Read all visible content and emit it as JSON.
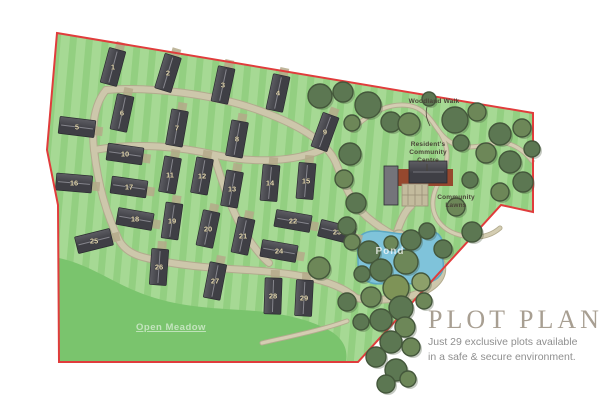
{
  "title_block": {
    "title": "PLOT PLAN",
    "subtitle_line1": "Just 29 exclusive plots available",
    "subtitle_line2": "in a safe & secure environment."
  },
  "map_labels": {
    "woodland_walk": "Woodland Walk",
    "community_centre_l1": "Resident's",
    "community_centre_l2": "Community",
    "community_centre_l3": "Centre",
    "community_lawns_l1": "Community",
    "community_lawns_l2": "Lawns",
    "pond": "Pond",
    "open_meadow": "Open Meadow"
  },
  "colors": {
    "boundary": "#e03c3c",
    "grass_light": "#a6d994",
    "grass_base": "#93cf81",
    "meadow": "#7ac46d",
    "road_casing": "#b2ab8e",
    "road_fill": "#cdc7ab",
    "path_fill": "#d4cdb2",
    "building_dark": "#3f3f45",
    "building_light": "#5d5d63",
    "building_ridge": "#85858c",
    "building_stroke": "#2b2b30",
    "drive": "#b4a989",
    "number": "#e8dcb4",
    "tree_d": "#5c7752",
    "tree_m": "#6d8758",
    "tree_l": "#7e9357",
    "tree_s": "#8da06a",
    "tree_stroke": "#44573b",
    "tree_shadow": "#3e5136",
    "pond_fill": "#7fc3da",
    "pond_stroke": "#5ca8c2",
    "brown": "#96482e",
    "centre_roof": "#66666c",
    "centre_roof_light": "#74747a",
    "parking": "#c3bb9d",
    "parking_line": "#998f76",
    "label_text": "#4a4538",
    "title": "#a89f92",
    "subtitle": "#8f8f8f"
  },
  "site": {
    "outline": "M57,33 L533,113 L533,212 L501,205 L358,362 L59,362 L58,205 L47,150 Z",
    "meadow": "M59,258 C95,266 115,286 155,298 C195,310 230,308 265,312 C295,316 315,322 332,332 C344,340 348,350 346,362 L59,362 Z",
    "pond": "M357,247 C355,238 363,231 375,231 C388,231 397,235 409,234 C421,233 431,228 438,234 C446,241 441,251 443,261 C445,272 439,280 427,283 C413,286 399,281 387,283 C373,286 361,281 359,271 C357,264 359,255 357,247 Z",
    "community": {
      "rects": [
        {
          "x": 398,
          "y": 169,
          "w": 55,
          "h": 17,
          "color": "brown"
        },
        {
          "x": 384,
          "y": 166,
          "w": 14,
          "h": 39,
          "color": "centre_roof_light",
          "stroke": "building_stroke"
        },
        {
          "x": 402,
          "y": 184,
          "w": 26,
          "h": 22,
          "color": "parking",
          "stroke": "parking_line"
        },
        {
          "x": 409,
          "y": 161,
          "w": 38,
          "h": 22,
          "color": "centre_roof",
          "stroke": "building_stroke"
        }
      ],
      "lines": [
        {
          "x1": 413,
          "y1": 172,
          "x2": 444,
          "y2": 172,
          "color": "building_ridge"
        },
        {
          "x1": 408,
          "y1": 185,
          "x2": 408,
          "y2": 205,
          "color": "parking_line"
        },
        {
          "x1": 415,
          "y1": 185,
          "x2": 415,
          "y2": 205,
          "color": "parking_line"
        },
        {
          "x1": 422,
          "y1": 185,
          "x2": 422,
          "y2": 205,
          "color": "parking_line"
        },
        {
          "x1": 402,
          "y1": 195,
          "x2": 428,
          "y2": 195,
          "color": "parking_line"
        }
      ]
    }
  },
  "roads": {
    "main": [
      "M106,90 C152,86 216,95 258,110 C297,124 327,141 336,163 C343,181 351,203 367,217 C379,227 391,234 399,238",
      "M106,90 C96,102 91,122 94,150 C98,184 106,214 119,240 C127,255 143,258 166,262 C216,271 263,268 306,277 C331,282 347,290 356,298",
      "M94,150 C140,142 181,147 216,155 C256,164 296,161 321,150",
      "M214,156 C224,188 234,218 250,241 C257,251 263,258 269,263",
      "M399,238 C426,243 440,253 442,266 C444,280 431,290 411,296 C394,300 370,301 356,298",
      "M397,232 C401,220 405,211 411,206"
    ],
    "paths": [
      "M352,130 C368,114 384,105 402,105 C420,105 428,115 436,127 C444,139 453,147 469,147 C485,147 495,141 506,143 C518,146 526,153 532,161",
      "M436,127 C452,147 448,165 440,180 C432,194 430,207 437,219 C443,229 453,234 464,236 C480,239 492,235 500,228",
      "M262,343 C292,336 322,330 347,321"
    ]
  },
  "plots": [
    {
      "n": "1",
      "x": 113,
      "y": 67,
      "r": -75
    },
    {
      "n": "2",
      "x": 168,
      "y": 73,
      "r": -73
    },
    {
      "n": "3",
      "x": 223,
      "y": 85,
      "r": -78
    },
    {
      "n": "4",
      "x": 278,
      "y": 93,
      "r": -78
    },
    {
      "n": "5",
      "x": 77,
      "y": 127,
      "r": 7
    },
    {
      "n": "6",
      "x": 122,
      "y": 113,
      "r": -78
    },
    {
      "n": "7",
      "x": 177,
      "y": 128,
      "r": -80
    },
    {
      "n": "8",
      "x": 237,
      "y": 139,
      "r": -80
    },
    {
      "n": "9",
      "x": 325,
      "y": 132,
      "r": -70
    },
    {
      "n": "10",
      "x": 125,
      "y": 154,
      "r": 8
    },
    {
      "n": "11",
      "x": 170,
      "y": 175,
      "r": -80
    },
    {
      "n": "12",
      "x": 202,
      "y": 176,
      "r": -80
    },
    {
      "n": "13",
      "x": 232,
      "y": 189,
      "r": -80
    },
    {
      "n": "14",
      "x": 270,
      "y": 183,
      "r": -85
    },
    {
      "n": "15",
      "x": 306,
      "y": 181,
      "r": -85
    },
    {
      "n": "16",
      "x": 74,
      "y": 183,
      "r": 5
    },
    {
      "n": "17",
      "x": 129,
      "y": 187,
      "r": 8
    },
    {
      "n": "18",
      "x": 135,
      "y": 219,
      "r": 10
    },
    {
      "n": "19",
      "x": 172,
      "y": 221,
      "r": -82
    },
    {
      "n": "20",
      "x": 208,
      "y": 229,
      "r": -78
    },
    {
      "n": "21",
      "x": 243,
      "y": 236,
      "r": -78
    },
    {
      "n": "22",
      "x": 293,
      "y": 221,
      "r": 10
    },
    {
      "n": "23",
      "x": 337,
      "y": 232,
      "r": 14
    },
    {
      "n": "24",
      "x": 279,
      "y": 251,
      "r": 10
    },
    {
      "n": "25",
      "x": 94,
      "y": 241,
      "r": -14
    },
    {
      "n": "26",
      "x": 159,
      "y": 267,
      "r": -86
    },
    {
      "n": "27",
      "x": 215,
      "y": 281,
      "r": -79
    },
    {
      "n": "28",
      "x": 273,
      "y": 296,
      "r": -88
    },
    {
      "n": "29",
      "x": 304,
      "y": 298,
      "r": -87
    }
  ],
  "trees": [
    [
      320,
      96,
      12,
      "d"
    ],
    [
      343,
      92,
      10,
      "d"
    ],
    [
      368,
      105,
      13,
      "d"
    ],
    [
      352,
      123,
      8,
      "m"
    ],
    [
      391,
      122,
      10,
      "d"
    ],
    [
      409,
      124,
      11,
      "m"
    ],
    [
      429,
      99,
      7,
      "d"
    ],
    [
      455,
      120,
      13,
      "d"
    ],
    [
      477,
      112,
      9,
      "m"
    ],
    [
      500,
      134,
      11,
      "d"
    ],
    [
      522,
      128,
      9,
      "m"
    ],
    [
      532,
      149,
      8,
      "d"
    ],
    [
      486,
      153,
      10,
      "m"
    ],
    [
      510,
      162,
      11,
      "d"
    ],
    [
      461,
      143,
      8,
      "d"
    ],
    [
      523,
      182,
      10,
      "d"
    ],
    [
      500,
      192,
      9,
      "m"
    ],
    [
      470,
      180,
      8,
      "d"
    ],
    [
      350,
      154,
      11,
      "d"
    ],
    [
      344,
      179,
      9,
      "m"
    ],
    [
      356,
      203,
      10,
      "d"
    ],
    [
      347,
      226,
      9,
      "d"
    ],
    [
      456,
      207,
      9,
      "m"
    ],
    [
      472,
      232,
      10,
      "d"
    ],
    [
      443,
      249,
      9,
      "d"
    ],
    [
      352,
      242,
      8,
      "m"
    ],
    [
      369,
      252,
      11,
      "d"
    ],
    [
      391,
      243,
      7,
      "m"
    ],
    [
      411,
      240,
      10,
      "d"
    ],
    [
      427,
      231,
      8,
      "d"
    ],
    [
      406,
      262,
      12,
      "m"
    ],
    [
      381,
      270,
      11,
      "d"
    ],
    [
      362,
      274,
      8,
      "d"
    ],
    [
      396,
      288,
      13,
      "l"
    ],
    [
      421,
      282,
      9,
      "s"
    ],
    [
      371,
      297,
      10,
      "m"
    ],
    [
      347,
      302,
      9,
      "d"
    ],
    [
      401,
      308,
      12,
      "d"
    ],
    [
      424,
      301,
      8,
      "m"
    ],
    [
      381,
      320,
      11,
      "d"
    ],
    [
      405,
      327,
      10,
      "m"
    ],
    [
      361,
      322,
      8,
      "d"
    ],
    [
      391,
      342,
      11,
      "d"
    ],
    [
      411,
      347,
      9,
      "m"
    ],
    [
      376,
      357,
      10,
      "d"
    ],
    [
      396,
      370,
      11,
      "d"
    ],
    [
      386,
      384,
      9,
      "d"
    ],
    [
      408,
      379,
      8,
      "m"
    ],
    [
      319,
      268,
      11,
      "m"
    ]
  ]
}
